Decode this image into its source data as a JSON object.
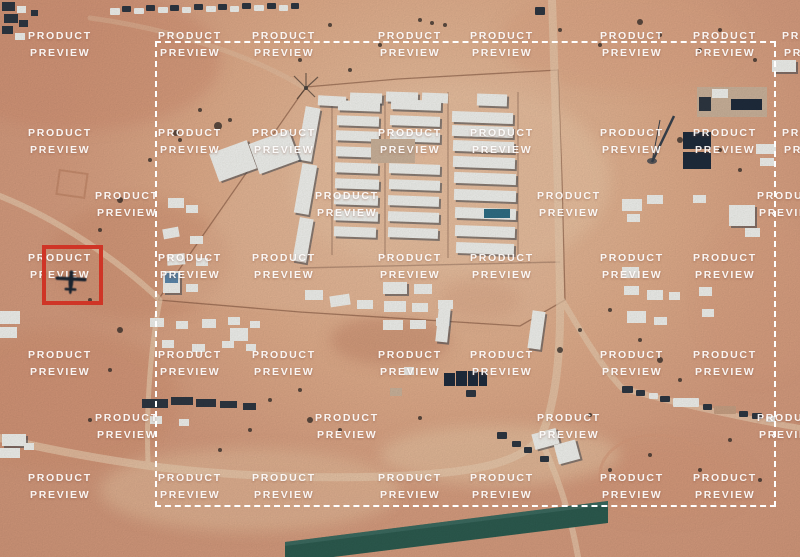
{
  "image": {
    "width": 800,
    "height": 557
  },
  "colors": {
    "sand_base": "#d89e80",
    "sand_light": "#ecc6a5",
    "sand_dark": "#c5886a",
    "runway_teal": "#2d5c50",
    "red_box": "#cf3526",
    "dash_white": "#ffffff",
    "watermark_white": "#ffffff",
    "building_white": "#f3f4f0",
    "shadow_dark": "#2e3742"
  },
  "watermark": {
    "line1": "PRODUCT",
    "line2": "PREVIEW",
    "positions": [
      [
        28,
        28
      ],
      [
        158,
        28
      ],
      [
        252,
        28
      ],
      [
        378,
        28
      ],
      [
        470,
        28
      ],
      [
        600,
        28
      ],
      [
        693,
        28
      ],
      [
        782,
        28
      ],
      [
        28,
        125
      ],
      [
        158,
        125
      ],
      [
        252,
        125
      ],
      [
        378,
        125
      ],
      [
        470,
        125
      ],
      [
        600,
        125
      ],
      [
        693,
        125
      ],
      [
        782,
        125
      ],
      [
        95,
        188
      ],
      [
        315,
        188
      ],
      [
        537,
        188
      ],
      [
        757,
        188
      ],
      [
        28,
        250
      ],
      [
        158,
        250
      ],
      [
        252,
        250
      ],
      [
        378,
        250
      ],
      [
        470,
        250
      ],
      [
        600,
        250
      ],
      [
        693,
        250
      ],
      [
        28,
        347
      ],
      [
        158,
        347
      ],
      [
        252,
        347
      ],
      [
        378,
        347
      ],
      [
        470,
        347
      ],
      [
        600,
        347
      ],
      [
        693,
        347
      ],
      [
        95,
        410
      ],
      [
        315,
        410
      ],
      [
        537,
        410
      ],
      [
        757,
        410
      ],
      [
        28,
        470
      ],
      [
        158,
        470
      ],
      [
        252,
        470
      ],
      [
        378,
        470
      ],
      [
        470,
        470
      ],
      [
        600,
        470
      ],
      [
        693,
        470
      ]
    ]
  },
  "annotations": {
    "selection_box": {
      "x": 155,
      "y": 41,
      "width": 621,
      "height": 466,
      "color": "#ffffff",
      "style": "dashed"
    },
    "highlight_box": {
      "x": 42,
      "y": 245,
      "width": 61,
      "height": 60,
      "color": "#cf3526",
      "style": "solid"
    },
    "aircraft": {
      "x": 51,
      "y": 260,
      "width": 40,
      "height": 40,
      "color": "#1b232e",
      "kind": "drone-silhouette"
    }
  },
  "scene": {
    "palette": {
      "w": "#f3f4f0",
      "d": "#2e3742",
      "n": "#1f2c3d",
      "t": "#c9a184",
      "g": "#cdb49c",
      "b": "#5d89ad",
      "p": "#2f6f86",
      "sh": "#3c4551"
    },
    "buildings": [
      [
        318,
        96,
        28,
        10,
        3
      ],
      [
        350,
        93,
        32,
        10,
        2
      ],
      [
        386,
        92,
        32,
        10,
        2
      ],
      [
        422,
        93,
        26,
        10,
        2
      ],
      [
        477,
        94,
        30,
        12,
        2
      ],
      [
        301,
        107,
        15,
        54,
        10
      ],
      [
        298,
        164,
        15,
        50,
        10
      ],
      [
        296,
        218,
        14,
        44,
        10
      ],
      [
        338,
        101,
        42,
        10,
        2
      ],
      [
        337,
        116,
        42,
        10,
        2
      ],
      [
        336,
        131,
        43,
        10,
        2
      ],
      [
        336,
        147,
        43,
        10,
        2
      ],
      [
        335,
        163,
        43,
        10,
        2
      ],
      [
        335,
        179,
        44,
        10,
        2
      ],
      [
        334,
        195,
        44,
        10,
        2
      ],
      [
        334,
        211,
        44,
        10,
        2
      ],
      [
        334,
        227,
        42,
        10,
        2
      ],
      [
        391,
        100,
        50,
        10,
        2
      ],
      [
        390,
        116,
        50,
        10,
        2
      ],
      [
        390,
        132,
        50,
        10,
        2
      ],
      [
        389,
        164,
        51,
        10,
        2
      ],
      [
        389,
        180,
        51,
        10,
        2
      ],
      [
        388,
        196,
        51,
        10,
        2
      ],
      [
        388,
        212,
        51,
        10,
        2
      ],
      [
        388,
        228,
        50,
        10,
        2
      ],
      [
        371,
        139,
        44,
        24,
        0,
        "g"
      ],
      [
        452,
        112,
        61,
        11,
        2
      ],
      [
        452,
        126,
        61,
        11,
        2
      ],
      [
        453,
        141,
        61,
        11,
        2
      ],
      [
        453,
        157,
        62,
        11,
        2
      ],
      [
        454,
        173,
        62,
        11,
        2
      ],
      [
        454,
        190,
        62,
        11,
        2
      ],
      [
        455,
        208,
        61,
        11,
        2
      ],
      [
        455,
        226,
        60,
        11,
        2
      ],
      [
        456,
        243,
        58,
        11,
        2
      ],
      [
        484,
        209,
        26,
        9,
        0,
        "p"
      ],
      [
        213,
        146,
        40,
        30,
        -20
      ],
      [
        253,
        136,
        42,
        32,
        -20
      ],
      [
        168,
        198,
        16,
        10,
        0
      ],
      [
        186,
        205,
        12,
        8,
        0
      ],
      [
        163,
        228,
        16,
        10,
        -10
      ],
      [
        190,
        236,
        13,
        8,
        0
      ],
      [
        167,
        254,
        18,
        11,
        -5
      ],
      [
        196,
        258,
        12,
        8,
        0
      ],
      [
        163,
        271,
        17,
        22,
        0
      ],
      [
        165,
        273,
        13,
        10,
        0,
        "b"
      ],
      [
        186,
        284,
        12,
        8,
        0
      ],
      [
        150,
        318,
        14,
        9
      ],
      [
        176,
        321,
        12,
        8
      ],
      [
        202,
        319,
        14,
        9
      ],
      [
        228,
        317,
        12,
        8
      ],
      [
        250,
        321,
        10,
        7
      ],
      [
        162,
        340,
        12,
        8
      ],
      [
        192,
        344,
        13,
        8
      ],
      [
        222,
        341,
        12,
        7
      ],
      [
        246,
        344,
        10,
        7
      ],
      [
        230,
        328,
        18,
        13
      ],
      [
        305,
        290,
        18,
        10
      ],
      [
        330,
        295,
        20,
        11,
        -8
      ],
      [
        357,
        300,
        16,
        9
      ],
      [
        383,
        282,
        24,
        12
      ],
      [
        414,
        284,
        18,
        10
      ],
      [
        384,
        301,
        22,
        11
      ],
      [
        412,
        303,
        16,
        9
      ],
      [
        438,
        300,
        15,
        9
      ],
      [
        383,
        320,
        20,
        10
      ],
      [
        410,
        320,
        16,
        9
      ],
      [
        436,
        318,
        14,
        8
      ],
      [
        437,
        308,
        12,
        34,
        6
      ],
      [
        530,
        311,
        13,
        38,
        8
      ],
      [
        404,
        367,
        10,
        8
      ],
      [
        390,
        388,
        12,
        8,
        0,
        "g"
      ],
      [
        444,
        373,
        11,
        13,
        0,
        "n"
      ],
      [
        456,
        371,
        11,
        15,
        0,
        "n"
      ],
      [
        468,
        371,
        10,
        15,
        0,
        "n"
      ],
      [
        479,
        372,
        8,
        14,
        0,
        "n"
      ],
      [
        683,
        132,
        28,
        17,
        0,
        "n"
      ],
      [
        683,
        152,
        28,
        17,
        0,
        "n"
      ],
      [
        697,
        87,
        70,
        30,
        0,
        "g"
      ],
      [
        712,
        89,
        16,
        9
      ],
      [
        731,
        99,
        31,
        11,
        0,
        "n"
      ],
      [
        699,
        97,
        12,
        14,
        0,
        "d"
      ],
      [
        622,
        199,
        20,
        12
      ],
      [
        647,
        195,
        16,
        9
      ],
      [
        627,
        214,
        13,
        8
      ],
      [
        729,
        205,
        26,
        21
      ],
      [
        745,
        228,
        15,
        9
      ],
      [
        693,
        195,
        13,
        8
      ],
      [
        622,
        267,
        17,
        11
      ],
      [
        624,
        286,
        15,
        9
      ],
      [
        647,
        290,
        16,
        10
      ],
      [
        699,
        287,
        13,
        9
      ],
      [
        669,
        292,
        11,
        8
      ],
      [
        627,
        311,
        19,
        12
      ],
      [
        654,
        317,
        13,
        8
      ],
      [
        702,
        309,
        12,
        8
      ],
      [
        756,
        144,
        20,
        10
      ],
      [
        760,
        158,
        14,
        8
      ],
      [
        772,
        60,
        24,
        12
      ],
      [
        533,
        431,
        25,
        16,
        -15
      ],
      [
        556,
        442,
        22,
        20,
        -15
      ],
      [
        142,
        399,
        26,
        9,
        0,
        "d"
      ],
      [
        171,
        397,
        22,
        8,
        0,
        "d"
      ],
      [
        196,
        399,
        20,
        8,
        0,
        "d"
      ],
      [
        220,
        401,
        17,
        7,
        0,
        "d"
      ],
      [
        243,
        403,
        13,
        7,
        0,
        "d"
      ],
      [
        150,
        416,
        12,
        8
      ],
      [
        179,
        419,
        10,
        7
      ],
      [
        0,
        311,
        20,
        13
      ],
      [
        0,
        327,
        17,
        11
      ],
      [
        2,
        434,
        24,
        12
      ],
      [
        0,
        448,
        20,
        10
      ],
      [
        24,
        443,
        10,
        7
      ],
      [
        2,
        2,
        13,
        9,
        0,
        "d"
      ],
      [
        4,
        14,
        14,
        9,
        0,
        "d"
      ],
      [
        2,
        26,
        11,
        8,
        0,
        "d"
      ],
      [
        17,
        6,
        9,
        7
      ],
      [
        19,
        20,
        9,
        7,
        0,
        "d"
      ],
      [
        31,
        10,
        7,
        6,
        0,
        "d"
      ],
      [
        15,
        33,
        10,
        7
      ]
    ],
    "vehicles": [
      [
        110,
        8,
        10,
        7,
        "w"
      ],
      [
        122,
        6,
        9,
        6,
        "d"
      ],
      [
        134,
        8,
        10,
        6,
        "w"
      ],
      [
        146,
        5,
        9,
        6,
        "d"
      ],
      [
        158,
        7,
        10,
        6,
        "w"
      ],
      [
        170,
        5,
        9,
        6,
        "d"
      ],
      [
        182,
        7,
        9,
        6,
        "w"
      ],
      [
        194,
        4,
        9,
        6,
        "d"
      ],
      [
        206,
        6,
        10,
        6,
        "w"
      ],
      [
        218,
        4,
        9,
        6,
        "d"
      ],
      [
        230,
        6,
        9,
        6,
        "w"
      ],
      [
        242,
        3,
        9,
        6,
        "d"
      ],
      [
        254,
        5,
        10,
        6,
        "w"
      ],
      [
        267,
        3,
        9,
        6,
        "d"
      ],
      [
        279,
        5,
        9,
        6,
        "w"
      ],
      [
        291,
        3,
        8,
        6,
        "d"
      ],
      [
        622,
        386,
        11,
        7,
        "d"
      ],
      [
        636,
        390,
        9,
        6,
        "d"
      ],
      [
        649,
        393,
        9,
        6,
        "w"
      ],
      [
        660,
        396,
        10,
        6,
        "d"
      ],
      [
        673,
        398,
        26,
        9,
        "w"
      ],
      [
        703,
        404,
        9,
        6,
        "d"
      ],
      [
        714,
        406,
        22,
        8,
        "t"
      ],
      [
        739,
        411,
        9,
        6,
        "d"
      ],
      [
        752,
        413,
        10,
        6,
        "d"
      ],
      [
        766,
        416,
        9,
        6,
        "w"
      ],
      [
        497,
        432,
        10,
        7,
        "d"
      ],
      [
        512,
        441,
        9,
        6,
        "d"
      ],
      [
        524,
        447,
        8,
        6,
        "d"
      ],
      [
        540,
        456,
        9,
        6,
        "d"
      ],
      [
        466,
        390,
        10,
        7,
        "d"
      ],
      [
        535,
        7,
        10,
        8,
        "d"
      ]
    ],
    "specks": [
      [
        420,
        20,
        2
      ],
      [
        432,
        23,
        2
      ],
      [
        445,
        25,
        2
      ],
      [
        330,
        25,
        2
      ],
      [
        350,
        70,
        2
      ],
      [
        380,
        45,
        2
      ],
      [
        300,
        60,
        2
      ],
      [
        560,
        30,
        2
      ],
      [
        600,
        45,
        2
      ],
      [
        640,
        22,
        3
      ],
      [
        660,
        35,
        2
      ],
      [
        700,
        50,
        2
      ],
      [
        720,
        30,
        2
      ],
      [
        755,
        60,
        2
      ],
      [
        218,
        126,
        4
      ],
      [
        176,
        133,
        3
      ],
      [
        200,
        110,
        2
      ],
      [
        230,
        120,
        2
      ],
      [
        180,
        140,
        2
      ],
      [
        150,
        160,
        2
      ],
      [
        120,
        200,
        3
      ],
      [
        100,
        230,
        2
      ],
      [
        90,
        300,
        2
      ],
      [
        120,
        330,
        3
      ],
      [
        110,
        370,
        2
      ],
      [
        90,
        420,
        2
      ],
      [
        310,
        420,
        3
      ],
      [
        340,
        430,
        2
      ],
      [
        420,
        418,
        2
      ],
      [
        590,
        415,
        2
      ],
      [
        610,
        470,
        2
      ],
      [
        650,
        455,
        2
      ],
      [
        700,
        470,
        2
      ],
      [
        730,
        440,
        2
      ],
      [
        760,
        480,
        2
      ],
      [
        560,
        350,
        3
      ],
      [
        580,
        330,
        2
      ],
      [
        610,
        310,
        2
      ],
      [
        640,
        340,
        2
      ],
      [
        660,
        360,
        3
      ],
      [
        680,
        380,
        2
      ],
      [
        300,
        390,
        2
      ],
      [
        270,
        400,
        2
      ],
      [
        250,
        430,
        2
      ],
      [
        220,
        450,
        2
      ],
      [
        680,
        140,
        3
      ],
      [
        720,
        150,
        2
      ],
      [
        740,
        170,
        2
      ]
    ]
  }
}
